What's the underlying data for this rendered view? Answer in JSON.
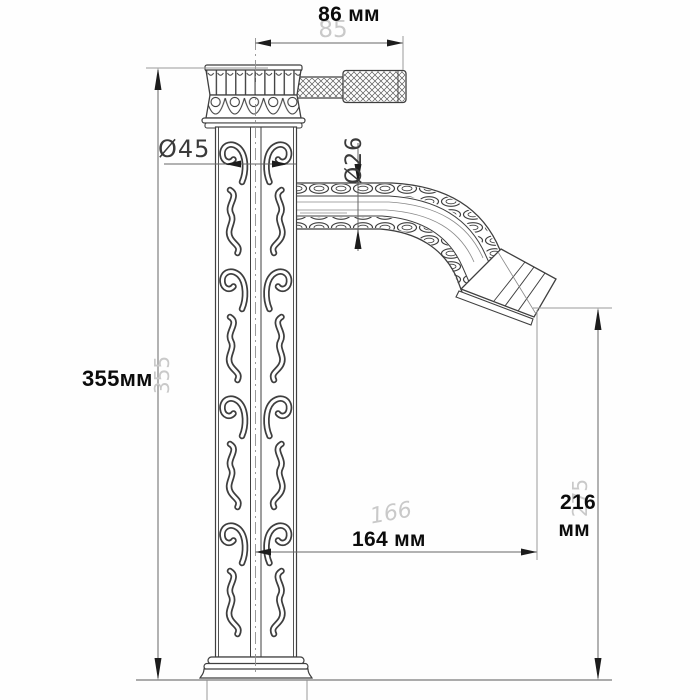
{
  "drawing": {
    "title": "Faucet technical dimension drawing",
    "units": "мм",
    "dimensions": {
      "top_width": {
        "label": "86 мм",
        "ghost": "85"
      },
      "height": {
        "label": "355мм",
        "ghost": "355"
      },
      "column_diameter": {
        "label": "Ø45"
      },
      "spout_diameter": {
        "label": "Ø26"
      },
      "reach": {
        "label": "164 мм",
        "ghost": "166"
      },
      "spout_height": {
        "value": "216",
        "unit": "мм",
        "ghost": "275"
      }
    },
    "colors": {
      "line": "#3f3f3f",
      "dim_line": "#666666",
      "extension_line": "#9a9a9a",
      "label_text": "#0c0c0c",
      "ghost_text": "#c9c9c9",
      "background": "#fefefe"
    }
  }
}
